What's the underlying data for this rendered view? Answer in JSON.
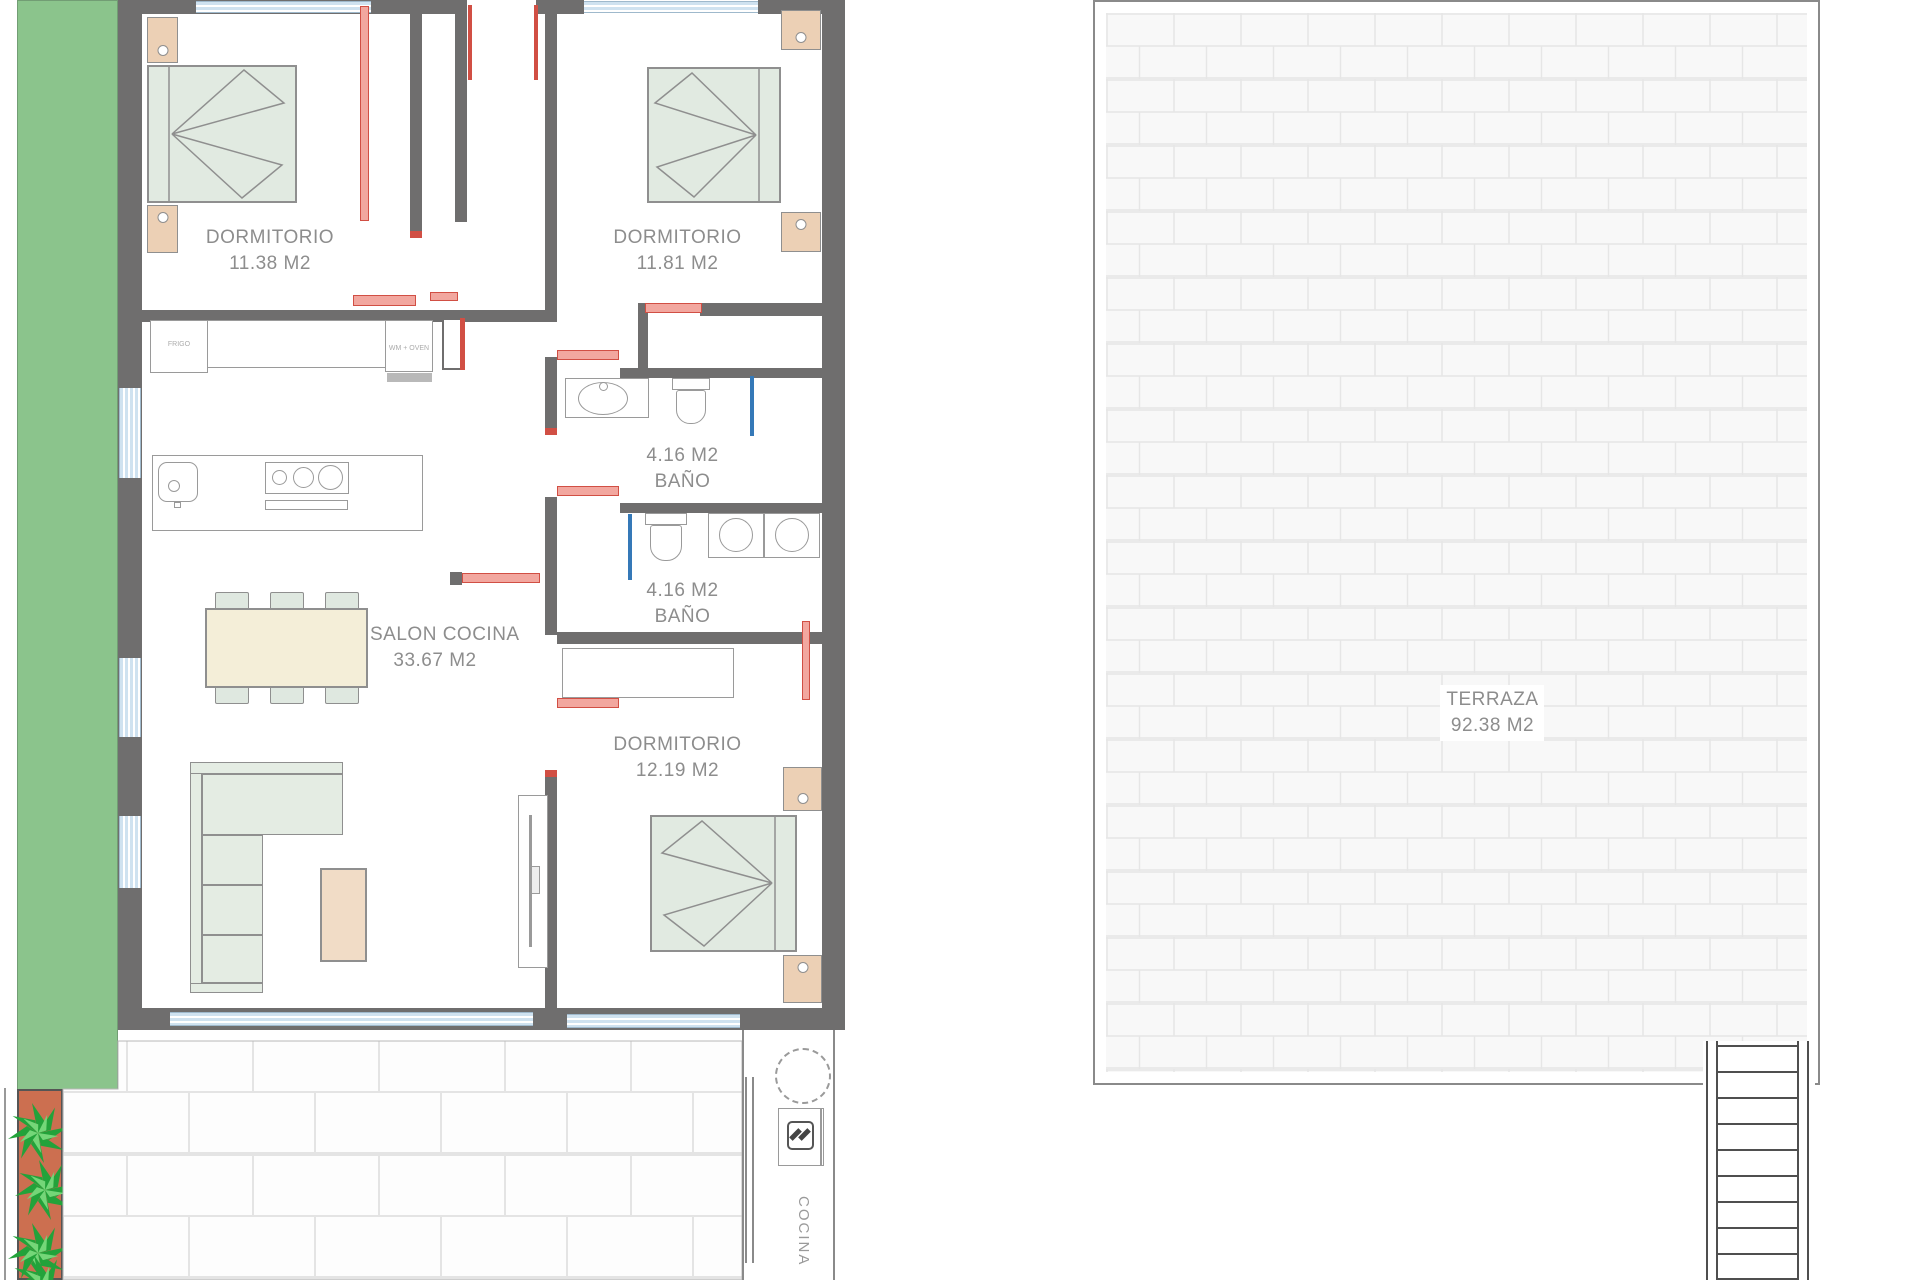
{
  "colors": {
    "wall": "#6f6e6e",
    "bed": "#e1eae1",
    "nstand": "#ecd0b5",
    "table": "#f4eed8",
    "chair": "#dfe8e0",
    "sofa": "#e4ece3",
    "coffee": "#f1dcc6",
    "red": "#d14f44",
    "redFill": "#f2a79f",
    "blue": "#3579b8",
    "windowBlue": "#cfe2f0",
    "windowEdge": "#9fb9cc",
    "garden": "#8bc48c",
    "planter": "#cc6f50",
    "text": "#8d8d8d",
    "furnLine": "#8f8f8f",
    "terraceBg": "#f8f8f8"
  },
  "rooms": {
    "bedroom1": {
      "name": "DORMITORIO",
      "area": "11.38 M2"
    },
    "bedroom2": {
      "name": "DORMITORIO",
      "area": "11.81 M2"
    },
    "bedroom3": {
      "name": "DORMITORIO",
      "area": "12.19 M2"
    },
    "bath1": {
      "area": "4.16 M2",
      "name": "BAÑO"
    },
    "bath2": {
      "area": "4.16 M2",
      "name": "BAÑO"
    },
    "salon": {
      "name": "SALON COCINA",
      "area": "33.67 M2"
    },
    "terraza": {
      "name": "TERRAZA",
      "area": "92.38 M2"
    },
    "outdoor_kitchen": {
      "name": "COCINA"
    }
  },
  "appliances": {
    "unit_left": "FRIGO",
    "unit_right": "WM + OVEN"
  }
}
